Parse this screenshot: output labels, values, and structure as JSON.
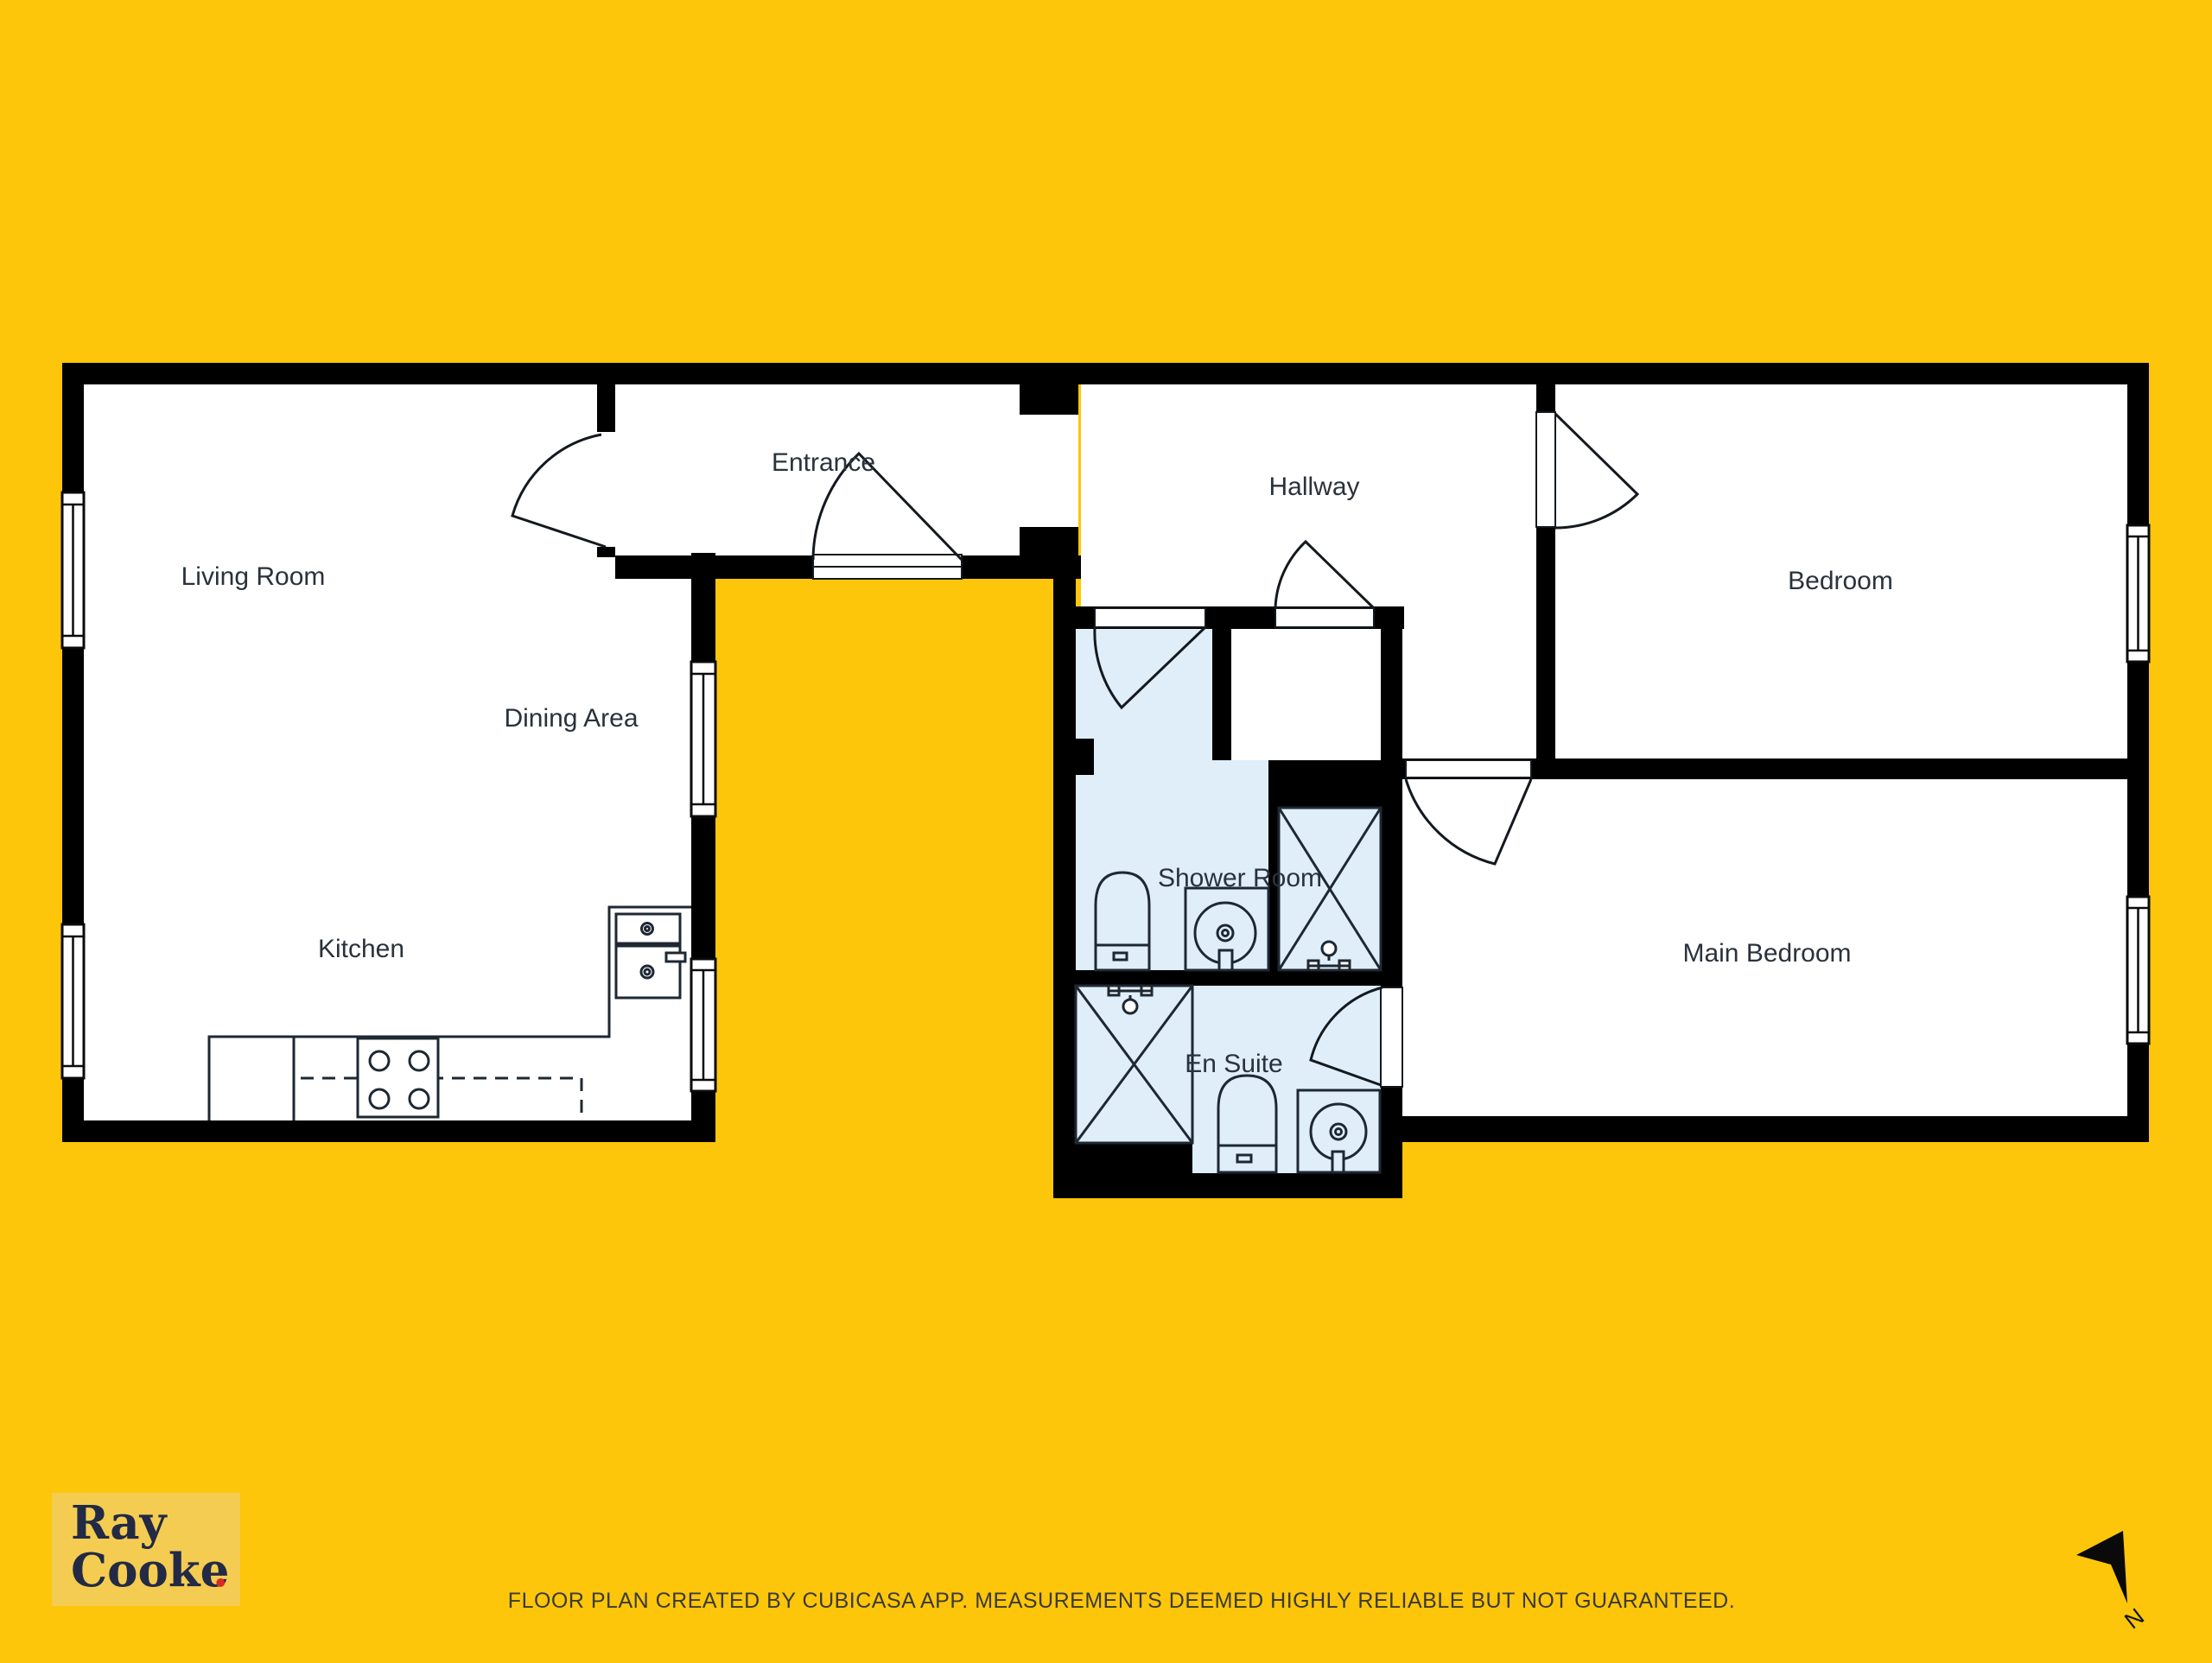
{
  "page": {
    "type": "floor-plan",
    "background_color": "#FDC60A",
    "disclaimer": "FLOOR PLAN CREATED BY CUBICASA APP. MEASUREMENTS DEEMED HIGHLY RELIABLE BUT NOT GUARANTEED."
  },
  "branding": {
    "logo_line1": "Ray",
    "logo_line2": "Cooke",
    "logo_dot": ".",
    "panel_color": "#F4CC52",
    "text_color": "#222A45",
    "dot_color": "#D62B28"
  },
  "compass": {
    "north_label": "N"
  },
  "rooms": {
    "living_room": {
      "label": "Living Room"
    },
    "dining_area": {
      "label": "Dining Area"
    },
    "kitchen": {
      "label": "Kitchen"
    },
    "entrance": {
      "label": "Entrance"
    },
    "hallway": {
      "label": "Hallway"
    },
    "bedroom": {
      "label": "Bedroom"
    },
    "main_bedroom": {
      "label": "Main Bedroom"
    },
    "shower_room": {
      "label": "Shower Room"
    },
    "en_suite": {
      "label": "En Suite"
    }
  },
  "fixtures": {
    "toilets": 2,
    "shower_trays": 2,
    "shower_enclosures": 2,
    "basin_taps": 2,
    "kitchen_sinks": 2,
    "stove_burners": 4,
    "windows": 6,
    "doors": 7
  },
  "colors": {
    "wall": "#000000",
    "floor": "#FFFFFF",
    "wet_room_fill": "#DFEEF9",
    "fixture_line": "#1E2833",
    "label_text": "#2A323C",
    "disclaimer_text": "#3A3A3A"
  }
}
